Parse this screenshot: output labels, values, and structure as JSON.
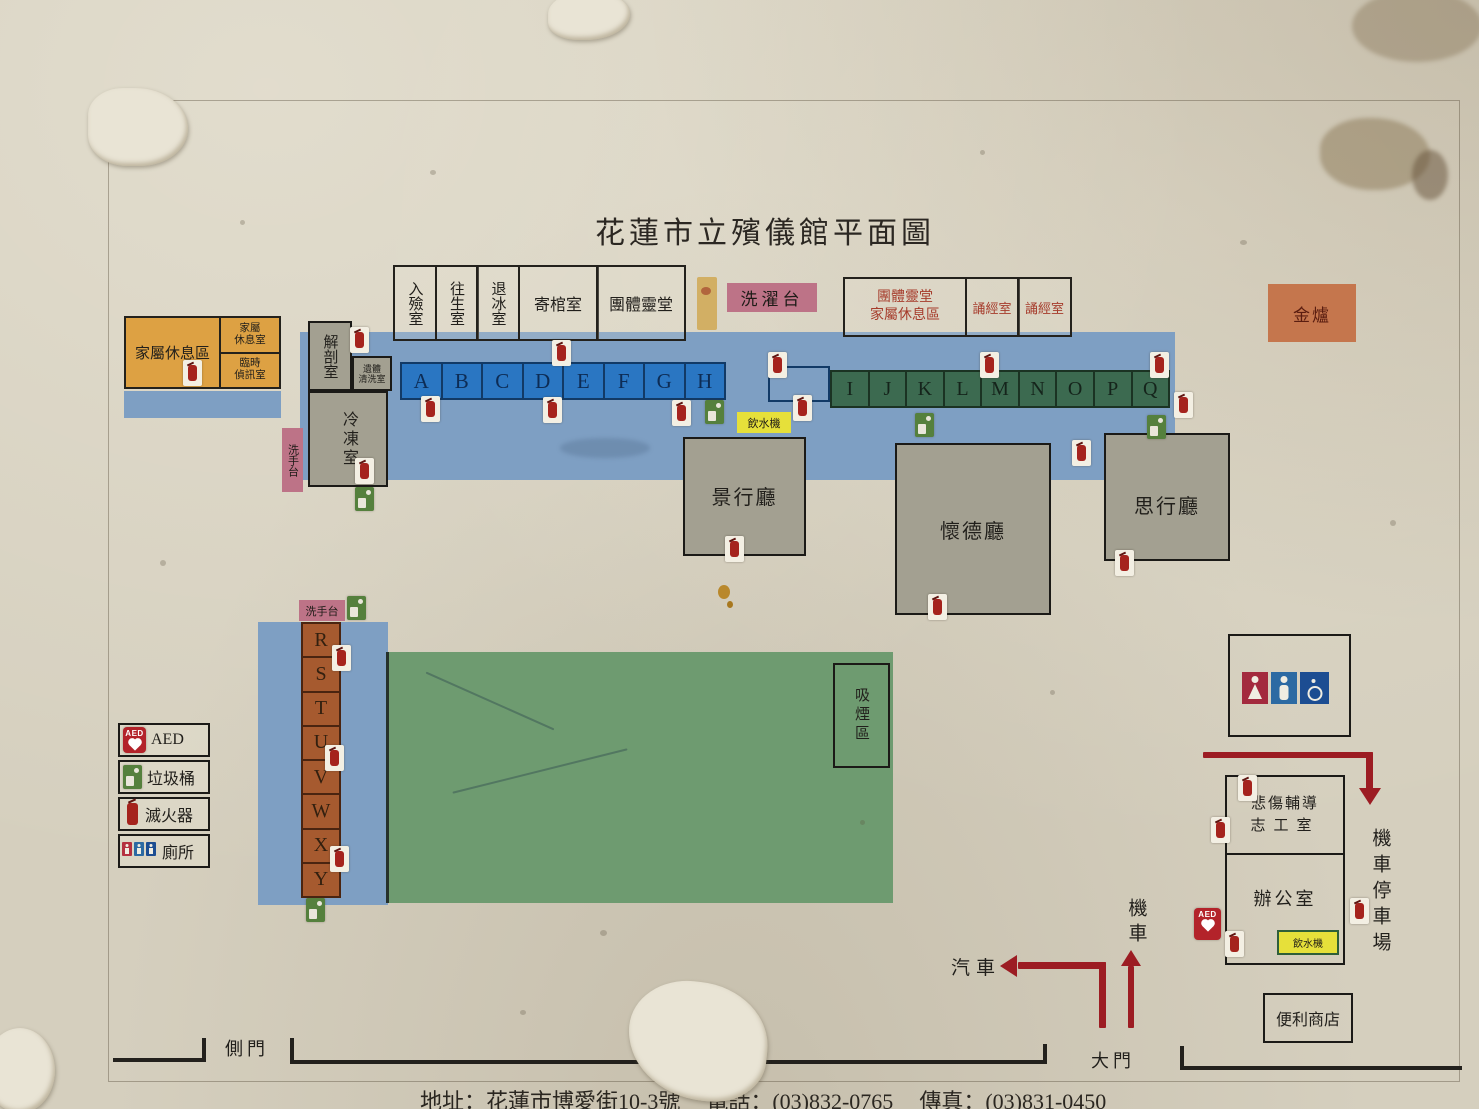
{
  "title": "花蓮市立殯儀館平面圖",
  "top_rooms": {
    "encoffin": "入殮室",
    "mortuary": "往生室",
    "thaw": "退冰室",
    "coffin_storage": "寄棺室",
    "group_hall": "團體靈堂"
  },
  "wash_station": "洗濯台",
  "group_rest": {
    "line1": "團體靈堂",
    "line2": "家屬休息區"
  },
  "chanting_room_1": "誦經室",
  "chanting_room_2": "誦經室",
  "incense_burner": "金爐",
  "family_rest": {
    "area": "家屬休息區",
    "room_line1": "家屬",
    "room_line2": "休息室",
    "temp_line1": "臨時",
    "temp_line2": "偵訊室"
  },
  "morgue": {
    "autopsy": "解剖室",
    "body_wash_line1": "遺體",
    "body_wash_line2": "清洗室",
    "freezer": "冷凍室"
  },
  "hand_wash_1": "洗手台",
  "hand_wash_2": "洗手台",
  "cells": {
    "ah": [
      "A",
      "B",
      "C",
      "D",
      "E",
      "F",
      "G",
      "H"
    ],
    "iq": [
      "I",
      "J",
      "K",
      "L",
      "M",
      "N",
      "O",
      "P",
      "Q"
    ],
    "ry": [
      "R",
      "S",
      "T",
      "U",
      "V",
      "W",
      "X",
      "Y"
    ]
  },
  "water_dispenser_1": "飲水機",
  "water_dispenser_2": "飲水機",
  "halls": {
    "jingxing": "景行廳",
    "huaide": "懷德廳",
    "sixing": "思行廳"
  },
  "smoking_area": "吸煙區",
  "legend": {
    "aed": "AED",
    "trash": "垃圾桶",
    "extinguisher": "滅火器",
    "toilet": "廁所"
  },
  "right_side": {
    "grief_line1": "悲傷輔導",
    "grief_line2": "志工室",
    "office": "辦公室",
    "moto_parking": "機車停車場",
    "store": "便利商店"
  },
  "traffic": {
    "car": "汽車",
    "moto": "機車",
    "main_gate": "大門",
    "side_gate": "側門"
  },
  "footer": {
    "address": "地址：花蓮市博愛街10-3號",
    "phone": "電話：(03)832-0765",
    "fax": "傳真：(03)831-0450"
  },
  "colors": {
    "corridor_blue": "#7e9fc3",
    "cell_blue": "#2a76c2",
    "cell_green": "#3c6a50",
    "cell_brown": "#a65a2f",
    "lawn_green": "#6e9b70",
    "room_gray": "#a3a091",
    "accent_orange": "#dda143",
    "label_pink": "#bd7387",
    "label_yellow": "#e6e03a",
    "terracotta": "#c5764d",
    "red_text": "#a63c2c",
    "arrow_red": "#9c1c23"
  },
  "icons": {
    "fire_extinguisher": "fire-extinguisher-icon",
    "trash_bin": "trash-bin-icon",
    "aed": "aed-icon",
    "toilet_female": "female-icon",
    "toilet_male": "male-icon",
    "toilet_accessible": "wheelchair-icon",
    "water_dispenser": "water-dispenser-label"
  }
}
